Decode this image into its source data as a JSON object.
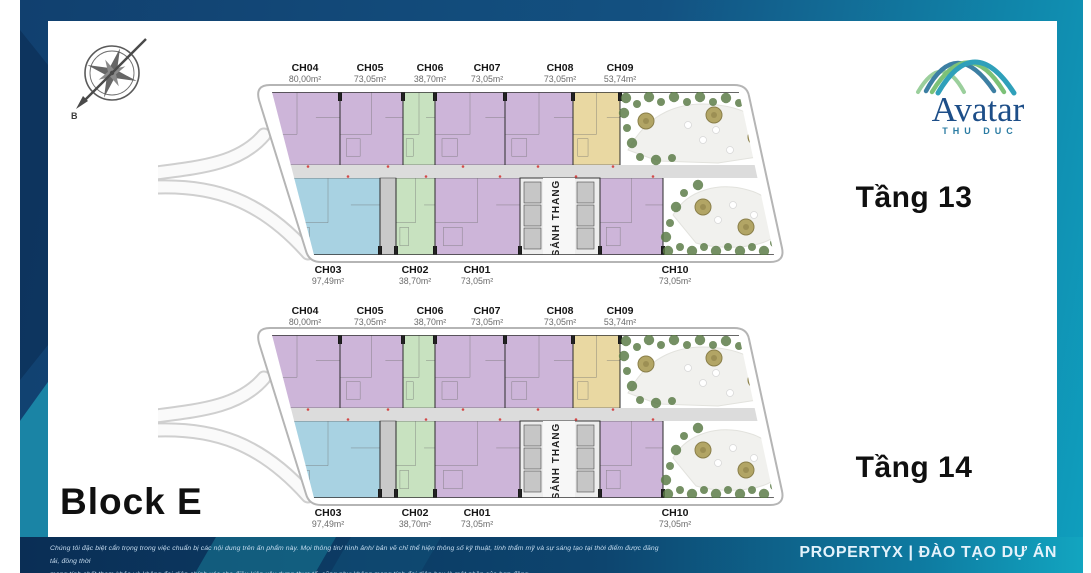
{
  "brand": {
    "logo_title": "Avatar",
    "logo_subtitle": "THU DUC"
  },
  "block_label": "Block E",
  "compass_label": "B",
  "core_label": "SẢNH THANG",
  "floors": [
    {
      "label": "Tầng 13",
      "units_top": [
        {
          "id": "CH04",
          "area": "80,00m²",
          "color": "purple"
        },
        {
          "id": "CH05",
          "area": "73,05m²",
          "color": "purple"
        },
        {
          "id": "CH06",
          "area": "38,70m²",
          "color": "green"
        },
        {
          "id": "CH07",
          "area": "73,05m²",
          "color": "purple"
        },
        {
          "id": "CH08",
          "area": "73,05m²",
          "color": "purple"
        },
        {
          "id": "CH09",
          "area": "53,74m²",
          "color": "yellow"
        }
      ],
      "units_bottom": [
        {
          "id": "CH03",
          "area": "97,49m²",
          "color": "blue"
        },
        {
          "id": "CH02",
          "area": "38,70m²",
          "color": "green"
        },
        {
          "id": "CH01",
          "area": "73,05m²",
          "color": "purple"
        },
        {
          "id": "CH10",
          "area": "73,05m²",
          "color": "purple"
        }
      ]
    },
    {
      "label": "Tầng 14",
      "units_top": [
        {
          "id": "CH04",
          "area": "80,00m²",
          "color": "purple"
        },
        {
          "id": "CH05",
          "area": "73,05m²",
          "color": "purple"
        },
        {
          "id": "CH06",
          "area": "38,70m²",
          "color": "green"
        },
        {
          "id": "CH07",
          "area": "73,05m²",
          "color": "purple"
        },
        {
          "id": "CH08",
          "area": "73,05m²",
          "color": "purple"
        },
        {
          "id": "CH09",
          "area": "53,74m²",
          "color": "yellow"
        }
      ],
      "units_bottom": [
        {
          "id": "CH03",
          "area": "97,49m²",
          "color": "blue"
        },
        {
          "id": "CH02",
          "area": "38,70m²",
          "color": "green"
        },
        {
          "id": "CH01",
          "area": "73,05m²",
          "color": "purple"
        },
        {
          "id": "CH10",
          "area": "73,05m²",
          "color": "purple"
        }
      ]
    }
  ],
  "footer": {
    "disclaimer_line1": "Chúng tôi đặc biệt cẩn trọng trong việc chuẩn bị các nội dung trên ấn phẩm này. Mọi thông tin/ hình ảnh/ bản vẽ chỉ thể hiện thông số kỹ thuật, tính thẩm mỹ và sự sáng tạo tại thời điểm được đăng tải, đồng thời",
    "disclaimer_line2": "mang tính chất tham khảo và không đại diện chính xác cho điều kiện xây dựng thực tế, cũng như không mang tính đại diện hay là một phần của hợp đồng.",
    "brand_text": "PROPERTYX | ĐÀO TẠO DỰ ÁN"
  },
  "colors": {
    "purple": "#cdb5d9",
    "green": "#c8e2c0",
    "yellow": "#e9d8a2",
    "blue": "#a8d2e2",
    "corridor": "#dcdcdc",
    "wall": "#1a1a1a",
    "navy": "#11406f",
    "teal": "#12a5c0"
  }
}
